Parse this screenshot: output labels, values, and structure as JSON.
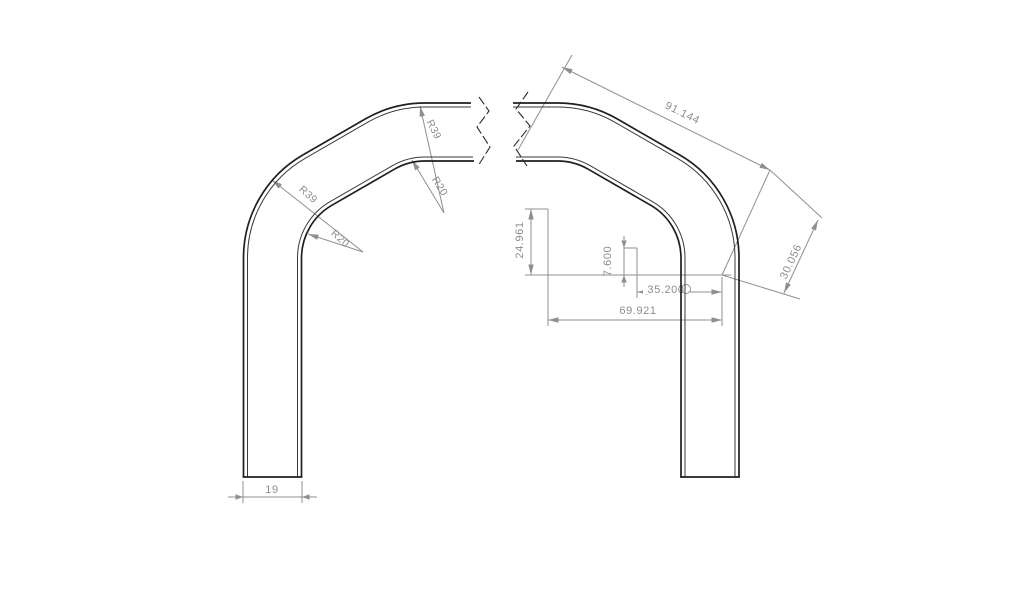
{
  "drawing": {
    "dim_slant_length": "91.144",
    "dim_slant_offset": "30.056",
    "dim_vertical_large": "24.961",
    "dim_vertical_small": "7.600",
    "dim_horiz_inner": "35.200",
    "dim_horiz_outer": "69.921",
    "dim_leg_width": "19",
    "radius_outer": "R39",
    "radius_inner": "R20",
    "colors": {
      "outline": "#1f1f1f",
      "dimension_gray": "#8f8f8f",
      "background": "#ffffff"
    }
  }
}
